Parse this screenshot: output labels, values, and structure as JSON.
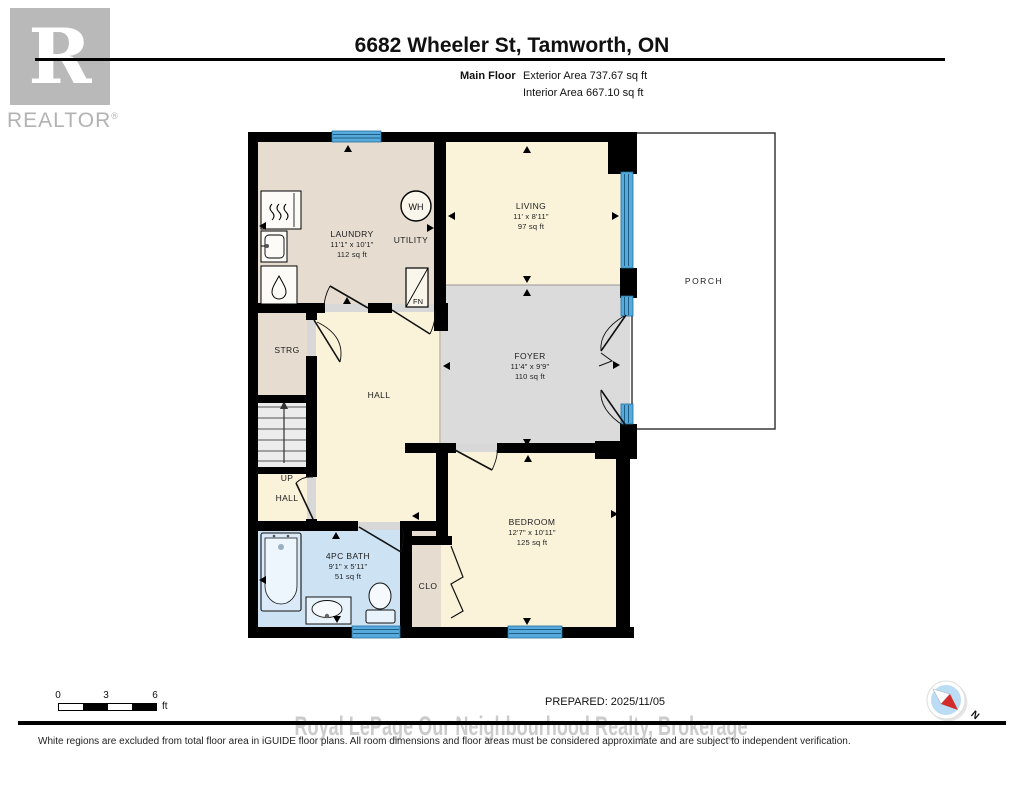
{
  "header": {
    "title": "6682 Wheeler St, Tamworth, ON",
    "floor_label": "Main Floor",
    "exterior_area": "Exterior Area 737.67 sq ft",
    "interior_area": "Interior Area 667.10 sq ft"
  },
  "logo": {
    "letter": "R",
    "brand": "REALTOR",
    "registered": "®"
  },
  "rooms": [
    {
      "id": "laundry",
      "name": "LAUNDRY",
      "dims": "11'1\" x 10'1\"",
      "area": "112 sq ft"
    },
    {
      "id": "utility",
      "name": "UTILITY"
    },
    {
      "id": "living",
      "name": "LIVING",
      "dims": "11' x 8'11\"",
      "area": "97 sq ft"
    },
    {
      "id": "foyer",
      "name": "FOYER",
      "dims": "11'4\" x 9'9\"",
      "area": "110 sq ft"
    },
    {
      "id": "porch",
      "name": "PORCH"
    },
    {
      "id": "storage",
      "name": "STRG"
    },
    {
      "id": "hall",
      "name": "HALL"
    },
    {
      "id": "stairs-up",
      "name": "UP"
    },
    {
      "id": "hall-lower",
      "name": "HALL"
    },
    {
      "id": "bath",
      "name": "4PC BATH",
      "dims": "9'1\" x 5'11\"",
      "area": "51 sq ft"
    },
    {
      "id": "closet",
      "name": "CLO"
    },
    {
      "id": "bedroom",
      "name": "BEDROOM",
      "dims": "12'7\" x 10'11\"",
      "area": "125 sq ft"
    }
  ],
  "fixtures": {
    "water_heater": "WH",
    "furnace": "FN"
  },
  "scale_bar": {
    "t0": "0",
    "t1": "3",
    "t2": "6",
    "unit": "ft"
  },
  "compass": {
    "north": "N"
  },
  "footer": {
    "prepared": "PREPARED: 2025/11/05",
    "watermark": "Royal LePage Our Neighbourhood Realty, Brokerage",
    "disclaimer": "White regions are excluded from total floor area in iGUIDE floor plans. All room dimensions and floor areas must be considered approximate and are subject to independent verification."
  },
  "colors": {
    "wall": "#000000",
    "window_blue": "#57aadb",
    "room_cream": "#faf3d9",
    "room_beige": "#e6ddd0",
    "room_gray": "#dbdbdb",
    "room_bath_blue": "#cde3f4",
    "stairs_gray": "#ececec",
    "compass_red": "#d22b2b",
    "watermark_gray": "#cbcbcb",
    "logo_gray": "#b9b9b9"
  }
}
